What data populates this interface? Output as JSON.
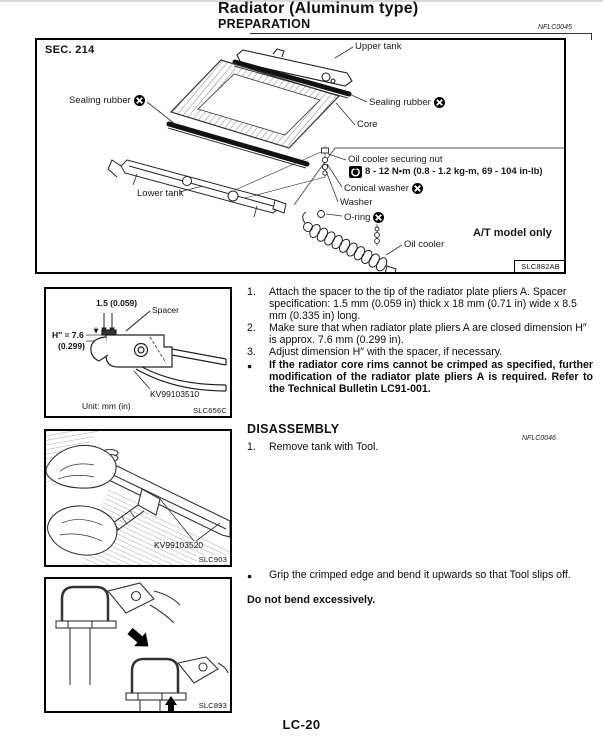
{
  "page": {
    "title": "Radiator (Aluminum type)",
    "heading": "PREPARATION",
    "heading_code": "NFLC0045",
    "footer_page_number": "LC-20"
  },
  "main_figure": {
    "sec": "SEC. 214",
    "upper_tank": "Upper tank",
    "sealing_rubber_right": "Sealing rubber",
    "core": "Core",
    "sealing_rubber_left": "Sealing rubber",
    "lower_tank": "Lower tank",
    "oil_cooler_securing_nut": "Oil cooler securing nut",
    "torque_spec": "8 - 12 N•m (0.8 - 1.2 kg-m, 69 - 104 in-lb)",
    "conical_washer": "Conical washer",
    "washer": "Washer",
    "o_ring": "O-ring",
    "oil_cooler": "Oil cooler",
    "at_model_note": "A/T model only",
    "figure_code": "SLC882AB"
  },
  "preparation": {
    "steps": [
      {
        "num": "1.",
        "text": "Attach the spacer to the tip of the radiator plate pliers A. Spacer specification: 1.5 mm (0.059 in) thick x 18 mm (0.71 in) wide x 8.5 mm (0.335 in) long."
      },
      {
        "num": "2.",
        "text": "Make sure that when radiator plate pliers A are closed dimension H″ is approx. 7.6 mm (0.299 in)."
      },
      {
        "num": "3.",
        "text": "Adjust dimension H″ with the spacer, if necessary."
      }
    ],
    "note_bullet": "●",
    "note": "If the radiator core rims cannot be crimped as specified, further modification of the radiator plate pliers A is required. Refer to the Technical Bulletin LC91-001."
  },
  "disassembly": {
    "heading": "DISASSEMBLY",
    "heading_code": "NFLC0046",
    "step_num": "1.",
    "step_text": "Remove tank with Tool.",
    "note_bullet": "●",
    "note": "Grip the crimped edge and bend it upwards so that Tool slips off.",
    "warning": "Do not bend excessively."
  },
  "figure1": {
    "dim_top": "1.5 (0.059)",
    "spacer": "Spacer",
    "h_dim_line1": "H″ = 7.6",
    "h_dim_line2": "(0.299)",
    "tool_number": "KV99103510",
    "unit_note": "Unit: mm (in)",
    "figure_code": "SLC656C"
  },
  "figure2": {
    "tool_number": "KV99103520",
    "figure_code": "SLC903"
  },
  "figure3": {
    "figure_code": "SLC893"
  }
}
